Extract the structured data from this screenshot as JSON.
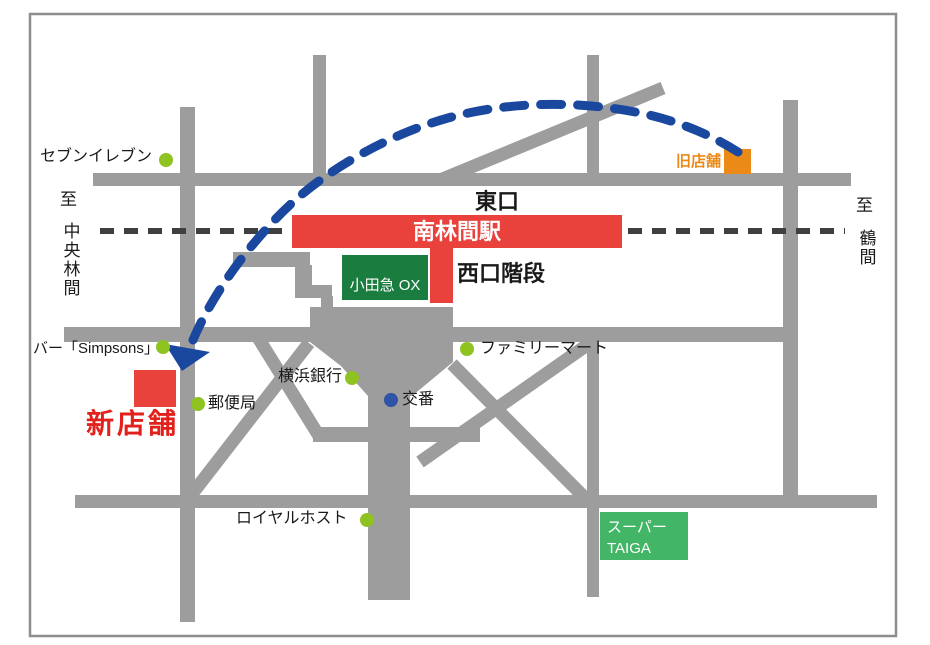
{
  "station": {
    "name": "南林間駅",
    "east_exit": "東口",
    "west_exit_stairs": "西口階段",
    "department_store": "小田急 OX"
  },
  "relocation": {
    "old_store": "旧店舗",
    "new_store": "新店舗"
  },
  "directions": {
    "left_to": "至",
    "left_destination": "中央林間",
    "right_to": "至",
    "right_destination": "鶴間"
  },
  "landmarks": {
    "seven_eleven": "セブンイレブン",
    "bar_simpsons": "バー「Simpsons」",
    "post_office": "郵便局",
    "yokohama_bank": "横浜銀行",
    "koban": "交番",
    "family_mart": "ファミリーマート",
    "royal_host": "ロイヤルホスト"
  },
  "supermarket": {
    "line1": "スーパー",
    "line2": "TAIGA"
  },
  "colors": {
    "road": "#9d9d9d",
    "frame": "#8e8e8e",
    "railway": "#3f3f3f",
    "station_red": "#e9413c",
    "ox_green": "#1a7c3e",
    "taiga_green": "#43b567",
    "old_store_orange": "#ec8a17",
    "arrow_blue": "#1b489f",
    "landmark_dot_green": "#8fc31f",
    "koban_dot_blue": "#2f54a5"
  }
}
